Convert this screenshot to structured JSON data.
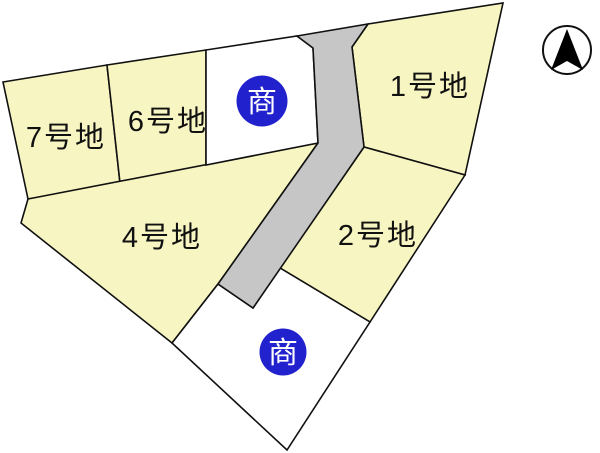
{
  "lots": {
    "lot1": {
      "label": "1号地"
    },
    "lot2": {
      "label": "2号地"
    },
    "lot4": {
      "label": "4号地"
    },
    "lot6": {
      "label": "6号地"
    },
    "lot7": {
      "label": "7号地"
    }
  },
  "badges": {
    "top": {
      "label": "商"
    },
    "bottom": {
      "label": "商"
    }
  },
  "compass": {
    "icon": "north-arrow"
  },
  "colors": {
    "lot_fill": "#f7f5c1",
    "white_lot_fill": "#ffffff",
    "road_fill": "#c6c6c6",
    "outline": "#111111",
    "badge_fill": "#2121cd",
    "badge_text": "#ffffff",
    "compass_fill": "#ffffff",
    "compass_arrow": "#000000"
  }
}
